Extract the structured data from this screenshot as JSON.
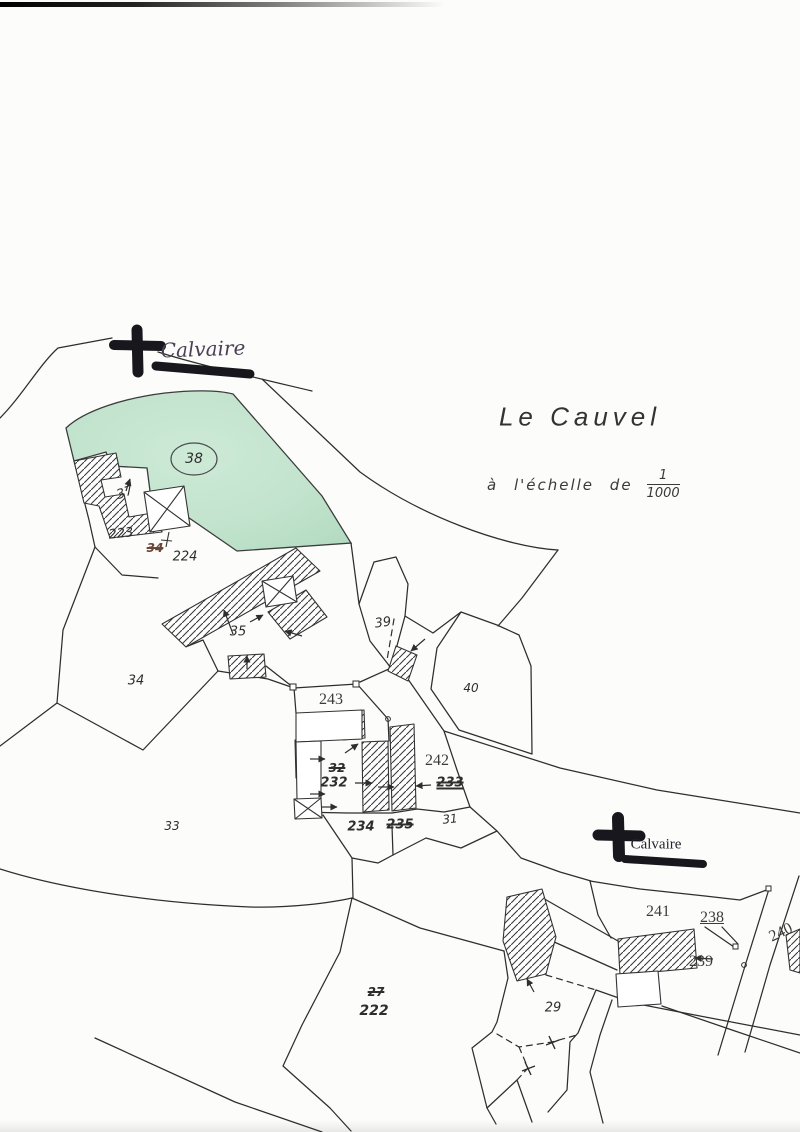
{
  "title": "Le Cauvel",
  "scale": {
    "prefix": "à l'échelle de",
    "numerator": "1",
    "denominator": "1000"
  },
  "landmarks": {
    "calvaire_top": "Calvaire",
    "calvaire_right": "Calvaire"
  },
  "labels": {
    "p38": "38",
    "p37": "37",
    "p223": "223",
    "p34_struck": "34",
    "p224": "224",
    "p35": "35",
    "p34": "34",
    "p39": "39",
    "p40": "40",
    "p243": "243",
    "p32_struck": "32",
    "p232": "232",
    "p242": "242",
    "p233_struck": "233",
    "p234": "234",
    "p235_struck": "235",
    "p31": "31",
    "p33": "33",
    "p27_struck": "27",
    "p222": "222",
    "p29": "29",
    "p241": "241",
    "p238": "238",
    "p239": "239",
    "p240": "240"
  },
  "colors": {
    "green_parcel": "#c6e5cf",
    "ink": "#2e2e2e",
    "cross_black": "#17171d",
    "handwriting_ink": "#4a3f55"
  }
}
